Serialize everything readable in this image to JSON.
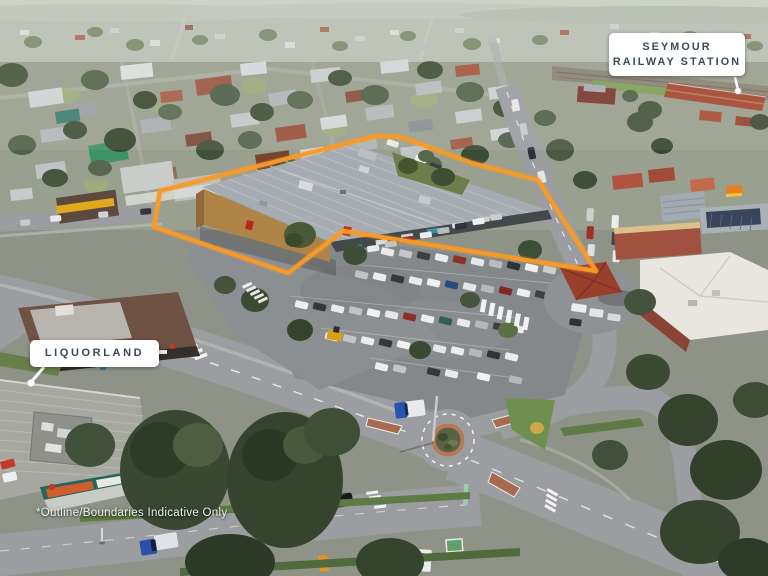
{
  "labels": {
    "station_line1": "SEYMOUR",
    "station_line2": "RAILWAY STATION",
    "liquorland": "LIQUORLAND"
  },
  "disclaimer": "*Outline/Boundaries Indicative Only",
  "colors": {
    "boundary_outline": "#F79A28",
    "callout_background": "#FFFFFF",
    "callout_text": "#3C4A52",
    "disclaimer_text": "#EFF1EE"
  }
}
